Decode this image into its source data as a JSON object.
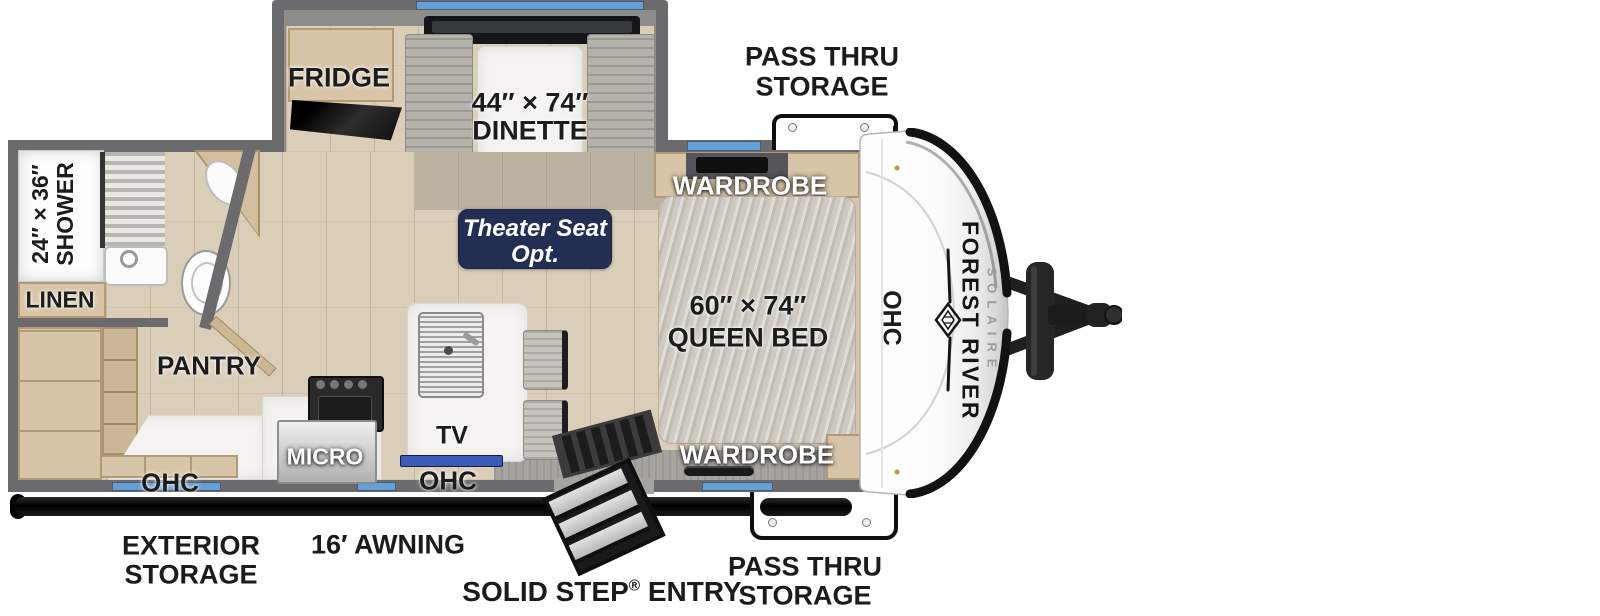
{
  "title": "Forest River Solaire travel trailer floorplan",
  "colors": {
    "wall": "#6b6a6d",
    "floor": "#dbceb9",
    "accent_blue": "#64a0d8",
    "tv_blue": "#3a5cb8",
    "badge_navy": "#232e54",
    "awning_black": "#111111",
    "cabinet_tan": "#d8c5a8",
    "marble": "#f4f3f1"
  },
  "exterior": {
    "pass_thru_top": [
      "PASS THRU",
      "STORAGE"
    ],
    "pass_thru_bottom": [
      "PASS THRU",
      "STORAGE"
    ],
    "exterior_storage": [
      "EXTERIOR",
      "STORAGE"
    ],
    "awning": "16′ AWNING",
    "entry": [
      "SOLID STEP",
      "®",
      " ENTRY"
    ]
  },
  "slideout": {
    "fridge": "FRIDGE",
    "dinette_size": "44″ × 74″",
    "dinette": "DINETTE"
  },
  "bedroom": {
    "wardrobe_top": "WARDROBE",
    "wardrobe_bottom": "WARDROBE",
    "bed_size": "60″ × 74″",
    "bed": "QUEEN BED",
    "ohc_front": "OHC"
  },
  "bathroom": {
    "shower_size": "24″ × 36″",
    "shower": "SHOWER",
    "linen": "LINEN"
  },
  "kitchen": {
    "pantry": "PANTRY",
    "micro": "MICRO",
    "tv": "TV",
    "ohc_left": "OHC",
    "ohc_mid": "OHC"
  },
  "living": {
    "theater_line1": "Theater Seat",
    "theater_line2": "Opt."
  },
  "front_cap": {
    "brand": "FOREST RIVER",
    "model": "SOLAIRE"
  }
}
